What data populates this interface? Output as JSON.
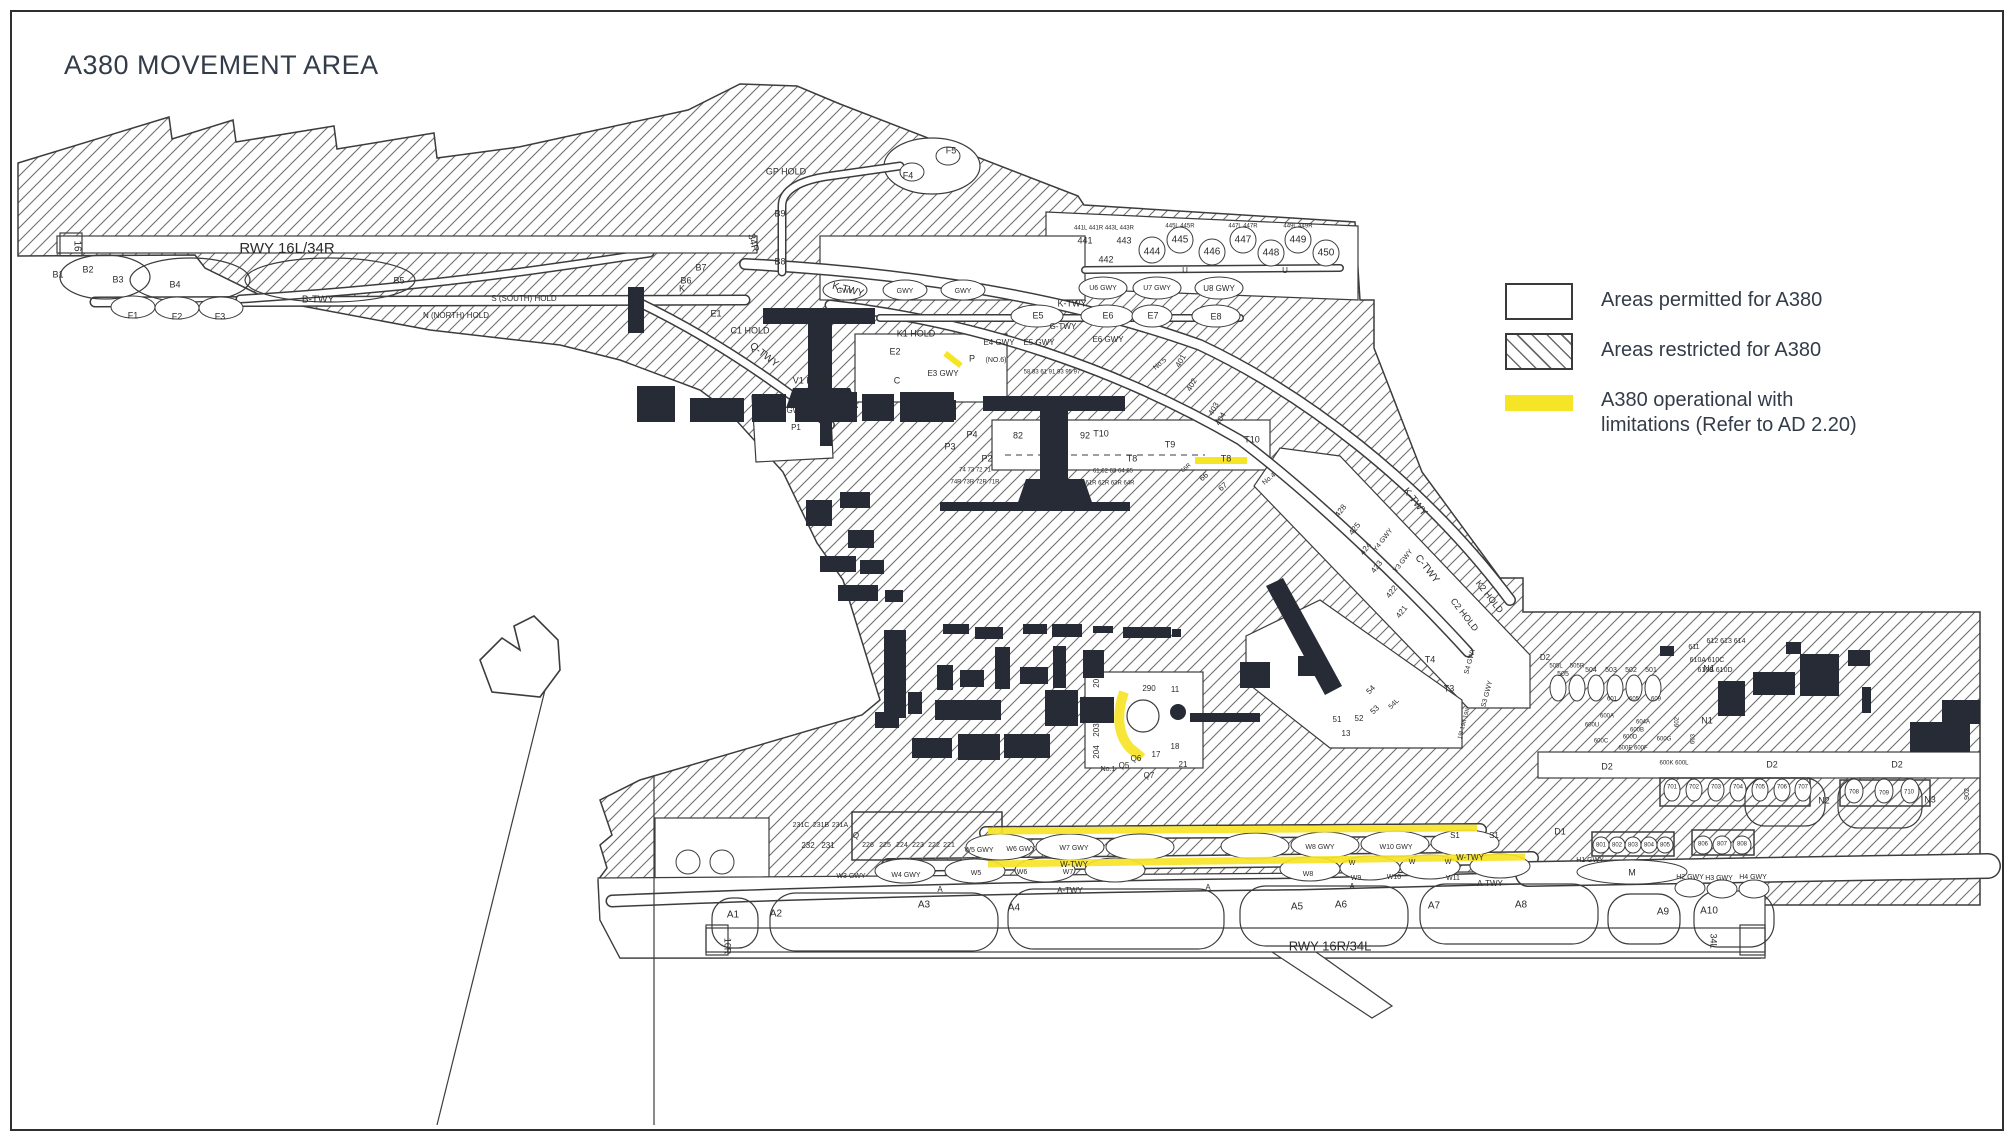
{
  "title": "A380 MOVEMENT AREA",
  "legend": {
    "items": [
      {
        "label": "Areas permitted for A380",
        "swatch": "permitted"
      },
      {
        "label": "Areas restricted for A380",
        "swatch": "restricted"
      },
      {
        "line1": "A380 operational with",
        "line2": "limitations (Refer to AD 2.20)",
        "swatch": "limited"
      }
    ]
  },
  "colors": {
    "limited_yellow": "#f6e427",
    "ink": "#3c3c3c",
    "building": "#262b36",
    "text": "#2b2b2b",
    "heading": "#333c49"
  },
  "runways": {
    "north": "RWY 16L/34R",
    "south": "RWY 16R/34L"
  },
  "map": {
    "labels": [
      [
        "RWY 16L/34R",
        287,
        249,
        15,
        0
      ],
      [
        "16",
        77,
        246,
        10,
        90
      ],
      [
        "34R",
        753,
        243,
        10,
        75
      ],
      [
        "B1",
        58,
        275,
        9,
        0
      ],
      [
        "B2",
        88,
        270,
        9,
        0
      ],
      [
        "B3",
        118,
        280,
        9,
        0
      ],
      [
        "B4",
        175,
        285,
        9,
        0
      ],
      [
        "B5",
        399,
        281,
        9,
        0
      ],
      [
        "F1",
        133,
        316,
        9,
        0
      ],
      [
        "F2",
        177,
        317,
        9,
        0
      ],
      [
        "F3",
        220,
        317,
        9,
        0
      ],
      [
        "B-TWY",
        318,
        300,
        10,
        0
      ],
      [
        "N (NORTH) HOLD",
        456,
        316,
        8,
        0
      ],
      [
        "S (SOUTH) HOLD",
        524,
        299,
        8,
        0
      ],
      [
        "GP HOLD",
        786,
        172,
        9,
        0
      ],
      [
        "B9",
        780,
        214,
        9,
        0
      ],
      [
        "B8",
        780,
        262,
        9,
        0
      ],
      [
        "B7",
        701,
        268,
        9,
        0
      ],
      [
        "B6",
        686,
        281,
        9,
        0
      ],
      [
        "K-TWY",
        848,
        290,
        10,
        14
      ],
      [
        "F5",
        951,
        151,
        9,
        0
      ],
      [
        "F4",
        908,
        176,
        9,
        0
      ],
      [
        "E1",
        716,
        314,
        9,
        0
      ],
      [
        "K",
        682,
        289,
        9,
        0
      ],
      [
        "C1 HOLD",
        750,
        331,
        9,
        0
      ],
      [
        "Q-TWY",
        764,
        355,
        10,
        38
      ],
      [
        "V1 HOLD",
        812,
        381,
        9,
        0
      ],
      [
        "K1 HOLD",
        916,
        334,
        9,
        0
      ],
      [
        "E2",
        895,
        352,
        9,
        0
      ],
      [
        "C",
        897,
        381,
        9,
        0
      ],
      [
        "E3 GWY",
        943,
        374,
        8,
        0
      ],
      [
        "E4 GWY",
        999,
        343,
        8,
        0
      ],
      [
        "E5 GWY",
        1039,
        343,
        8,
        0
      ],
      [
        "E6 GWY",
        1108,
        340,
        8,
        0
      ],
      [
        "P",
        972,
        359,
        9,
        0
      ],
      [
        "(NO.6)",
        996,
        360,
        7,
        0
      ],
      [
        "P1 GWY",
        790,
        411,
        8,
        0
      ],
      [
        "P1",
        796,
        428,
        8,
        0
      ],
      [
        "P2",
        987,
        459,
        9,
        0
      ],
      [
        "P3",
        950,
        447,
        9,
        0
      ],
      [
        "P4",
        972,
        435,
        9,
        0
      ],
      [
        "82",
        1018,
        436,
        9,
        0
      ],
      [
        "92",
        1085,
        436,
        9,
        0
      ],
      [
        "T10",
        1101,
        434,
        9,
        0
      ],
      [
        "T9",
        1170,
        445,
        9,
        0
      ],
      [
        "T8",
        1132,
        459,
        9,
        0
      ],
      [
        "T8",
        1226,
        459,
        9,
        0
      ],
      [
        "T10",
        1252,
        440,
        9,
        0
      ],
      [
        "No.5",
        1160,
        364,
        7,
        -40
      ],
      [
        "401",
        1181,
        361,
        8,
        -60
      ],
      [
        "402",
        1192,
        385,
        8,
        -60
      ],
      [
        "403",
        1214,
        409,
        8,
        -60
      ],
      [
        "404",
        1221,
        419,
        8,
        -60
      ],
      [
        "K-TWY",
        1072,
        304,
        9,
        0
      ],
      [
        "G-TWY",
        1063,
        327,
        8,
        0
      ],
      [
        "E5",
        1038,
        316,
        9,
        0
      ],
      [
        "E6",
        1108,
        316,
        9,
        0
      ],
      [
        "E7",
        1153,
        316,
        9,
        0
      ],
      [
        "E8",
        1216,
        317,
        9,
        0
      ],
      [
        "GWY",
        845,
        291,
        7,
        0
      ],
      [
        "GWY",
        905,
        291,
        7,
        0
      ],
      [
        "GWY",
        963,
        291,
        7,
        0
      ],
      [
        "U6 GWY",
        1103,
        288,
        7,
        0
      ],
      [
        "U7 GWY",
        1157,
        288,
        7,
        0
      ],
      [
        "U8 GWY",
        1219,
        289,
        8,
        0
      ],
      [
        "U",
        1185,
        271,
        8,
        0
      ],
      [
        "U",
        1285,
        271,
        8,
        0
      ],
      [
        "441",
        1085,
        241,
        9,
        0
      ],
      [
        "442",
        1106,
        260,
        9,
        0
      ],
      [
        "443",
        1124,
        241,
        9,
        0
      ],
      [
        "444",
        1152,
        252,
        10,
        0
      ],
      [
        "445",
        1180,
        240,
        10,
        0
      ],
      [
        "446",
        1212,
        252,
        10,
        0
      ],
      [
        "447",
        1243,
        240,
        10,
        0
      ],
      [
        "448",
        1271,
        253,
        10,
        0
      ],
      [
        "449",
        1298,
        240,
        10,
        0
      ],
      [
        "450",
        1326,
        253,
        10,
        0
      ],
      [
        "445L 445R",
        1180,
        226,
        6,
        0
      ],
      [
        "447L 447R",
        1243,
        226,
        6,
        0
      ],
      [
        "449L 449R",
        1298,
        226,
        6,
        0
      ],
      [
        "441L 441R 443L 443R",
        1104,
        228,
        6,
        0
      ],
      [
        "K2 HOLD",
        1489,
        597,
        9,
        52
      ],
      [
        "C2 HOLD",
        1464,
        615,
        9,
        52
      ],
      [
        "K-TWY",
        1415,
        502,
        10,
        52
      ],
      [
        "C-TWY",
        1427,
        569,
        10,
        52
      ],
      [
        "428",
        1341,
        511,
        8,
        -52
      ],
      [
        "425",
        1355,
        529,
        8,
        -52
      ],
      [
        "424",
        1366,
        549,
        8,
        -52
      ],
      [
        "423",
        1377,
        567,
        8,
        -52
      ],
      [
        "422",
        1392,
        592,
        8,
        -52
      ],
      [
        "421",
        1402,
        612,
        8,
        -52
      ],
      [
        "Y4 GWY",
        1383,
        540,
        7,
        -52
      ],
      [
        "Y3 GWY",
        1403,
        561,
        7,
        -52
      ],
      [
        "T4",
        1430,
        660,
        9,
        0
      ],
      [
        "T3",
        1449,
        689,
        9,
        0
      ],
      [
        "S4 GWY",
        1470,
        661,
        7,
        -75
      ],
      [
        "S3 GWY",
        1487,
        694,
        7,
        -75
      ],
      [
        "51",
        1337,
        720,
        8,
        0
      ],
      [
        "52",
        1359,
        719,
        8,
        0
      ],
      [
        "53",
        1375,
        710,
        8,
        -45
      ],
      [
        "54",
        1371,
        690,
        8,
        -45
      ],
      [
        "54L",
        1394,
        704,
        7,
        -45
      ],
      [
        "13",
        1346,
        734,
        8,
        0
      ],
      [
        "19I 19II 19III",
        1464,
        723,
        6,
        -75
      ],
      [
        "No.4",
        1269,
        479,
        7,
        -40
      ],
      [
        "66",
        1204,
        477,
        8,
        -40
      ],
      [
        "67",
        1223,
        487,
        8,
        -40
      ],
      [
        "66R",
        1186,
        468,
        6,
        -40
      ],
      [
        "74 73 72 71",
        975,
        470,
        6,
        0
      ],
      [
        "74R 73R 72R 71R",
        975,
        482,
        6,
        0
      ],
      [
        "61 62 63 64 65",
        1113,
        471,
        6,
        0
      ],
      [
        "61R 62R 63R 64R",
        1110,
        483,
        6,
        0
      ],
      [
        "58 83 61 91 93 95 97",
        1052,
        372,
        6,
        0
      ],
      [
        "201",
        1097,
        681,
        8,
        -90
      ],
      [
        "202",
        1097,
        708,
        8,
        -90
      ],
      [
        "203",
        1097,
        730,
        8,
        -90
      ],
      [
        "204",
        1097,
        752,
        8,
        -90
      ],
      [
        "290",
        1149,
        689,
        8,
        0
      ],
      [
        "11",
        1175,
        690,
        8,
        0
      ],
      [
        "No.1",
        1108,
        769,
        7,
        0
      ],
      [
        "Q5",
        1124,
        766,
        8,
        0
      ],
      [
        "Q6",
        1136,
        759,
        8,
        0
      ],
      [
        "Q7",
        1149,
        776,
        8,
        0
      ],
      [
        "17",
        1156,
        755,
        8,
        0
      ],
      [
        "18",
        1175,
        747,
        8,
        0
      ],
      [
        "21",
        1183,
        765,
        8,
        0
      ],
      [
        "231C",
        801,
        825,
        7,
        0
      ],
      [
        "231B",
        821,
        825,
        7,
        0
      ],
      [
        "231A",
        840,
        825,
        7,
        0
      ],
      [
        "232",
        808,
        846,
        8,
        0
      ],
      [
        "231",
        828,
        846,
        8,
        0
      ],
      [
        "Q",
        856,
        836,
        8,
        0
      ],
      [
        "226",
        868,
        845,
        7,
        0
      ],
      [
        "225",
        885,
        845,
        7,
        0
      ],
      [
        "224",
        902,
        845,
        7,
        0
      ],
      [
        "223",
        918,
        845,
        7,
        0
      ],
      [
        "222",
        934,
        845,
        7,
        0
      ],
      [
        "221",
        949,
        845,
        7,
        0
      ],
      [
        "W3 GWY",
        851,
        876,
        7,
        0
      ],
      [
        "W4 GWY",
        906,
        875,
        7,
        0
      ],
      [
        "W5 GWY",
        979,
        850,
        7,
        0
      ],
      [
        "W6 GWY",
        1021,
        849,
        7,
        0
      ],
      [
        "W7 GWY",
        1074,
        848,
        7,
        0
      ],
      [
        "W8 GWY",
        1320,
        847,
        7,
        0
      ],
      [
        "W10 GWY",
        1396,
        847,
        7,
        0
      ],
      [
        "W-TWY",
        1074,
        865,
        8,
        0
      ],
      [
        "W-TWY",
        1470,
        858,
        8,
        0
      ],
      [
        "W5",
        976,
        873,
        7,
        0
      ],
      [
        "W6",
        1022,
        872,
        7,
        0
      ],
      [
        "W7",
        1068,
        872,
        7,
        0
      ],
      [
        "W8",
        1308,
        874,
        7,
        0
      ],
      [
        "W9",
        1356,
        878,
        7,
        0
      ],
      [
        "W10",
        1394,
        877,
        7,
        0
      ],
      [
        "W11",
        1453,
        878,
        7,
        0
      ],
      [
        "W",
        1352,
        863,
        7,
        0
      ],
      [
        "W",
        1412,
        862,
        7,
        0
      ],
      [
        "W",
        1448,
        862,
        7,
        0
      ],
      [
        "S1",
        1455,
        836,
        8,
        0
      ],
      [
        "S1",
        1494,
        836,
        8,
        0
      ],
      [
        "A",
        940,
        890,
        8,
        0
      ],
      [
        "A",
        1208,
        888,
        8,
        0
      ],
      [
        "A",
        1352,
        887,
        8,
        0
      ],
      [
        "A-TWY",
        1070,
        891,
        8,
        0
      ],
      [
        "A-TWY",
        1490,
        884,
        8,
        0
      ],
      [
        "A1",
        733,
        915,
        10,
        0
      ],
      [
        "A2",
        776,
        914,
        10,
        0
      ],
      [
        "A3",
        924,
        905,
        10,
        0
      ],
      [
        "A4",
        1014,
        908,
        10,
        0
      ],
      [
        "A5",
        1297,
        907,
        10,
        0
      ],
      [
        "A6",
        1341,
        905,
        10,
        0
      ],
      [
        "A7",
        1434,
        906,
        10,
        0
      ],
      [
        "A8",
        1521,
        905,
        10,
        0
      ],
      [
        "A9",
        1663,
        912,
        10,
        0
      ],
      [
        "A10",
        1709,
        911,
        10,
        0
      ],
      [
        "RWY 16R/34L",
        1330,
        947,
        13,
        0
      ],
      [
        "16R",
        727,
        946,
        9,
        90
      ],
      [
        "34L",
        1713,
        941,
        9,
        90
      ],
      [
        "D1",
        1560,
        832,
        9,
        0
      ],
      [
        "M",
        1632,
        873,
        9,
        0
      ],
      [
        "H1 GWY",
        1590,
        860,
        7,
        0
      ],
      [
        "H2 GWY",
        1690,
        877,
        7,
        0
      ],
      [
        "H3 GWY",
        1719,
        878,
        7,
        0
      ],
      [
        "H4 GWY",
        1753,
        877,
        7,
        0
      ],
      [
        "801",
        1601,
        845,
        6,
        0
      ],
      [
        "802",
        1617,
        845,
        6,
        0
      ],
      [
        "803",
        1633,
        845,
        6,
        0
      ],
      [
        "804",
        1649,
        845,
        6,
        0
      ],
      [
        "805",
        1665,
        845,
        6,
        0
      ],
      [
        "806",
        1703,
        844,
        6,
        0
      ],
      [
        "807",
        1722,
        844,
        6,
        0
      ],
      [
        "808",
        1742,
        844,
        6,
        0
      ],
      [
        "D2",
        1607,
        767,
        9,
        0
      ],
      [
        "D2",
        1772,
        765,
        9,
        0
      ],
      [
        "D2",
        1897,
        765,
        9,
        0
      ],
      [
        "D2",
        1545,
        658,
        8,
        0
      ],
      [
        "701",
        1672,
        787,
        6,
        0
      ],
      [
        "702",
        1694,
        787,
        6,
        0
      ],
      [
        "703",
        1716,
        787,
        6,
        0
      ],
      [
        "704",
        1738,
        787,
        6,
        0
      ],
      [
        "705",
        1760,
        787,
        6,
        0
      ],
      [
        "706",
        1782,
        787,
        6,
        0
      ],
      [
        "707",
        1803,
        787,
        6,
        0
      ],
      [
        "708",
        1854,
        792,
        6,
        0
      ],
      [
        "709",
        1884,
        793,
        6,
        0
      ],
      [
        "710",
        1909,
        792,
        6,
        0
      ],
      [
        "N2",
        1824,
        801,
        9,
        0
      ],
      [
        "N3",
        1930,
        800,
        9,
        0
      ],
      [
        "902",
        1967,
        794,
        7,
        -90
      ],
      [
        "N1",
        1709,
        669,
        9,
        0
      ],
      [
        "N1",
        1707,
        721,
        9,
        0
      ],
      [
        "611",
        1694,
        647,
        7,
        0
      ],
      [
        "612 613 614",
        1726,
        641,
        7,
        0
      ],
      [
        "610A 610C",
        1707,
        660,
        7,
        0
      ],
      [
        "610B 610D",
        1715,
        670,
        7,
        0
      ],
      [
        "505L",
        1556,
        666,
        6,
        0
      ],
      [
        "505R",
        1577,
        666,
        6,
        0
      ],
      [
        "505",
        1563,
        674,
        7,
        0
      ],
      [
        "504",
        1591,
        670,
        7,
        0
      ],
      [
        "503",
        1611,
        670,
        7,
        0
      ],
      [
        "502",
        1631,
        670,
        7,
        0
      ],
      [
        "501",
        1651,
        670,
        7,
        0
      ],
      [
        "601",
        1612,
        699,
        6,
        0
      ],
      [
        "605",
        1634,
        699,
        6,
        0
      ],
      [
        "609",
        1656,
        699,
        6,
        0
      ],
      [
        "600U",
        1592,
        725,
        6,
        0
      ],
      [
        "600A",
        1607,
        716,
        6,
        0
      ],
      [
        "604A",
        1643,
        722,
        6,
        0
      ],
      [
        "600B",
        1637,
        730,
        6,
        0
      ],
      [
        "600D",
        1630,
        737,
        6,
        0
      ],
      [
        "600G",
        1664,
        739,
        6,
        0
      ],
      [
        "600C",
        1601,
        741,
        6,
        0
      ],
      [
        "600E 600F",
        1633,
        748,
        6,
        0
      ],
      [
        "600K 600L",
        1674,
        763,
        6,
        0
      ],
      [
        "602",
        1677,
        722,
        6,
        -90
      ],
      [
        "603",
        1693,
        739,
        6,
        -90
      ]
    ]
  }
}
